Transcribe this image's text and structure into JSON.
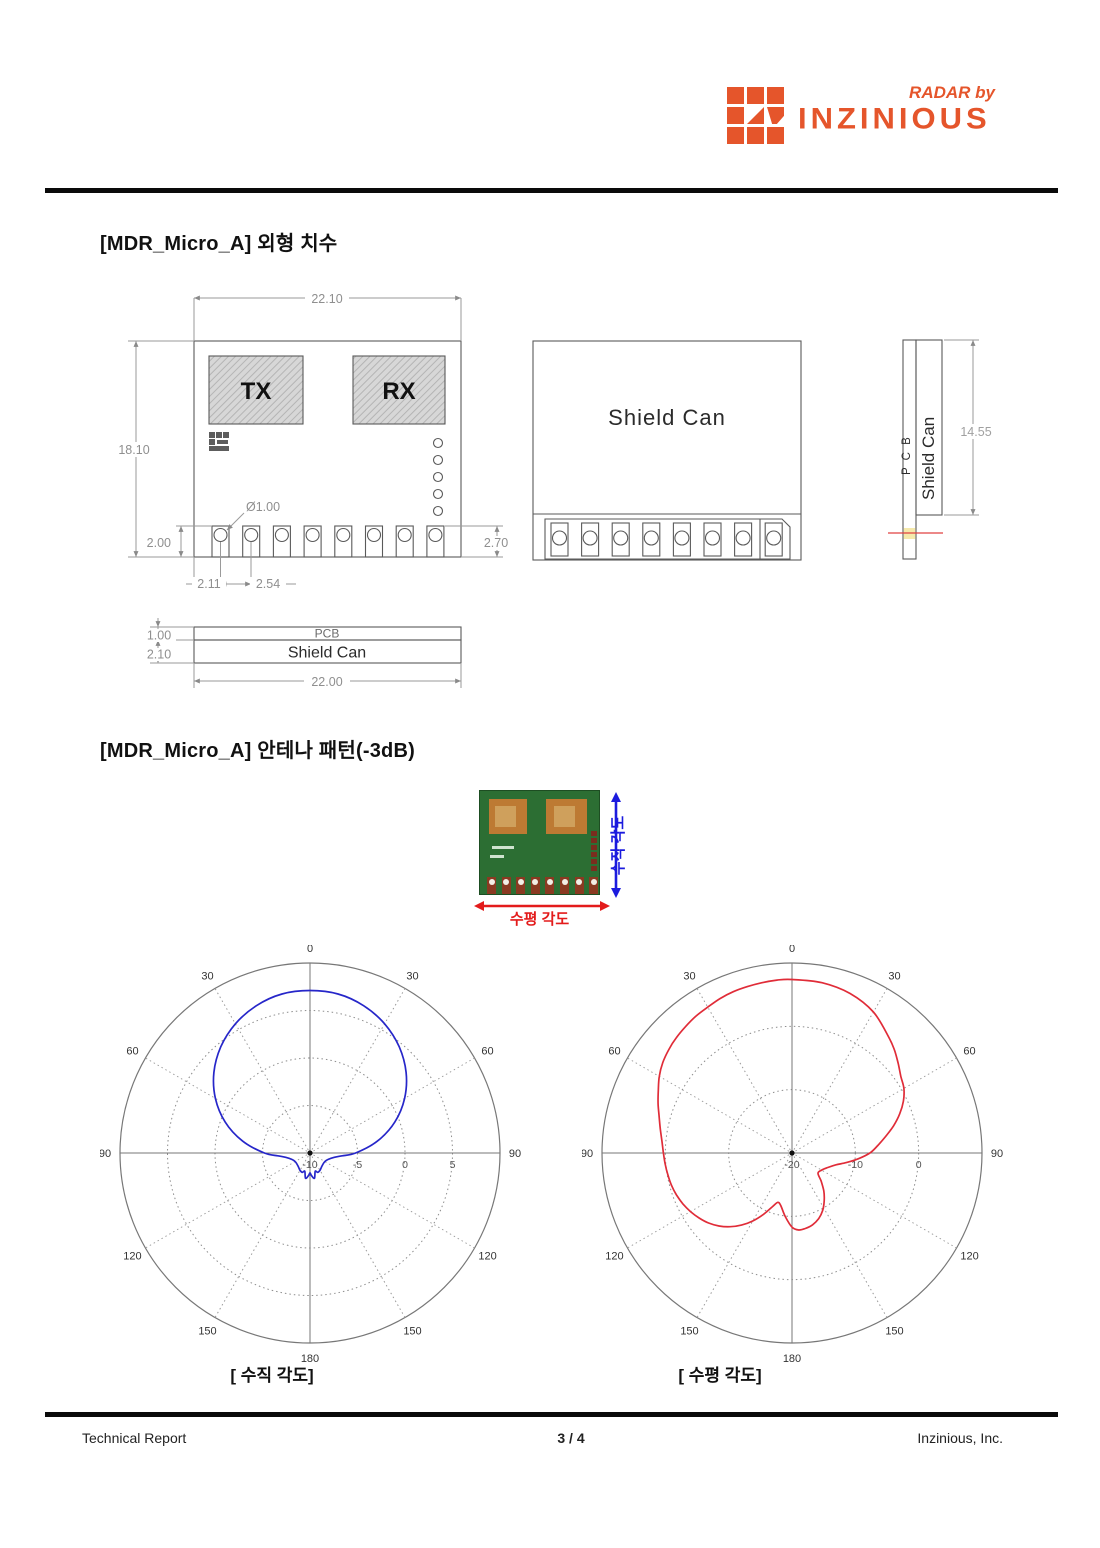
{
  "brand": {
    "tagline": "RADAR by",
    "name": "INZINIOUS",
    "color": "#e5552b"
  },
  "sections": {
    "dimensions_title": "[MDR_Micro_A] 외형 치수",
    "antenna_title": "[MDR_Micro_A] 안테나 패턴(-3dB)"
  },
  "drawing": {
    "front_view": {
      "tx_label": "TX",
      "rx_label": "RX",
      "width_dim": "22.10",
      "height_dim": "18.10",
      "pad_height_dim": "2.00",
      "hole_dim": "Ø1.00",
      "pitch_dim_1": "2.11",
      "pitch_dim_2": "2.54",
      "right_dim": "2.70"
    },
    "shield_view": {
      "label": "Shield Can"
    },
    "side_view": {
      "pcb_label": "P C B",
      "shield_label": "Shield Can",
      "height_dim": "14.55"
    },
    "stack_view": {
      "pcb_label": "PCB",
      "shield_label": "Shield Can",
      "pcb_dim": "1.00",
      "shield_dim": "2.10",
      "width_dim": "22.00"
    }
  },
  "photo": {
    "vertical_label": "수직 각도",
    "horizontal_label": "수평 각도",
    "vertical_color": "#1b1bde",
    "horizontal_color": "#e31b1b",
    "bottom_pad_count": 8,
    "side_pad_count": 6
  },
  "captions": {
    "left": "[ 수직 각도]",
    "right": "[ 수평 각도]"
  },
  "footer": {
    "left": "Technical Report",
    "page": "3 / 4",
    "right": "Inzinious, Inc."
  },
  "chart_data": [
    {
      "type": "line",
      "polar": true,
      "name": "vertical-angle-pattern",
      "title": "[ 수직 각도]",
      "color": "#2626c9",
      "grid": true,
      "angle_ticks": [
        {
          "a": 0,
          "t": "0"
        },
        {
          "a": 30,
          "t": "30"
        },
        {
          "a": -30,
          "t": "30"
        },
        {
          "a": 60,
          "t": "60"
        },
        {
          "a": -60,
          "t": "60"
        },
        {
          "a": 90,
          "t": "90"
        },
        {
          "a": -90,
          "t": "90"
        },
        {
          "a": 120,
          "t": "120"
        },
        {
          "a": -120,
          "t": "120"
        },
        {
          "a": 150,
          "t": "150"
        },
        {
          "a": -150,
          "t": "150"
        },
        {
          "a": 180,
          "t": "180"
        }
      ],
      "r_axis": {
        "min": -10,
        "max": 10,
        "ring_step": 5,
        "ticks": [
          {
            "v": -10,
            "t": "-10"
          },
          {
            "v": -5,
            "t": "-5"
          },
          {
            "v": 0,
            "t": "0"
          },
          {
            "v": 5,
            "t": "5"
          }
        ]
      },
      "points_deg_db": [
        [
          0,
          7.1
        ],
        [
          10,
          7.0
        ],
        [
          20,
          6.5
        ],
        [
          30,
          5.7
        ],
        [
          40,
          4.6
        ],
        [
          50,
          3.2
        ],
        [
          60,
          1.5
        ],
        [
          70,
          -0.5
        ],
        [
          80,
          -2.8
        ],
        [
          90,
          -5.2
        ],
        [
          95,
          -6.6
        ],
        [
          100,
          -7.4
        ],
        [
          110,
          -8.0
        ],
        [
          120,
          -8.2
        ],
        [
          130,
          -8.2
        ],
        [
          140,
          -8.1
        ],
        [
          150,
          -7.9
        ],
        [
          158,
          -7.8
        ],
        [
          164,
          -8.0
        ],
        [
          170,
          -7.3
        ],
        [
          176,
          -7.6
        ],
        [
          180,
          -7.9
        ],
        [
          184,
          -7.6
        ],
        [
          190,
          -7.3
        ],
        [
          196,
          -8.0
        ],
        [
          202,
          -7.8
        ],
        [
          210,
          -7.9
        ],
        [
          220,
          -8.1
        ],
        [
          230,
          -8.2
        ],
        [
          240,
          -8.2
        ],
        [
          250,
          -8.0
        ],
        [
          260,
          -7.4
        ],
        [
          265,
          -6.6
        ],
        [
          270,
          -5.2
        ],
        [
          280,
          -2.8
        ],
        [
          290,
          -0.5
        ],
        [
          300,
          1.5
        ],
        [
          310,
          3.2
        ],
        [
          320,
          4.6
        ],
        [
          330,
          5.7
        ],
        [
          340,
          6.5
        ],
        [
          350,
          7.0
        ]
      ]
    },
    {
      "type": "line",
      "polar": true,
      "name": "horizontal-angle-pattern",
      "title": "[ 수평 각도]",
      "color": "#e02c38",
      "grid": true,
      "angle_ticks": [
        {
          "a": 0,
          "t": "0"
        },
        {
          "a": 30,
          "t": "30"
        },
        {
          "a": -30,
          "t": "30"
        },
        {
          "a": 60,
          "t": "60"
        },
        {
          "a": -60,
          "t": "60"
        },
        {
          "a": 90,
          "t": "90"
        },
        {
          "a": -90,
          "t": "90"
        },
        {
          "a": 120,
          "t": "120"
        },
        {
          "a": -120,
          "t": "120"
        },
        {
          "a": 150,
          "t": "150"
        },
        {
          "a": -150,
          "t": "150"
        },
        {
          "a": 180,
          "t": "180"
        }
      ],
      "r_axis": {
        "min": -20,
        "max": 10,
        "ring_step": 10,
        "ticks": [
          {
            "v": -20,
            "t": "-20"
          },
          {
            "v": -10,
            "t": "-10"
          },
          {
            "v": 0,
            "t": "0"
          }
        ]
      },
      "points_deg_db": [
        [
          0,
          7.4
        ],
        [
          10,
          7.3
        ],
        [
          20,
          6.8
        ],
        [
          30,
          5.7
        ],
        [
          40,
          3.8
        ],
        [
          45,
          2.9
        ],
        [
          50,
          1.9
        ],
        [
          55,
          1.0
        ],
        [
          60,
          0.4
        ],
        [
          65,
          -0.6
        ],
        [
          70,
          -1.9
        ],
        [
          75,
          -3.4
        ],
        [
          80,
          -5.0
        ],
        [
          85,
          -6.4
        ],
        [
          90,
          -7.7
        ],
        [
          95,
          -9.5
        ],
        [
          100,
          -11.3
        ],
        [
          105,
          -12.8
        ],
        [
          112,
          -13.9
        ],
        [
          120,
          -14.6
        ],
        [
          128,
          -14.8
        ],
        [
          134,
          -13.6
        ],
        [
          140,
          -12.2
        ],
        [
          146,
          -10.9
        ],
        [
          152,
          -9.7
        ],
        [
          158,
          -8.8
        ],
        [
          164,
          -8.2
        ],
        [
          170,
          -7.9
        ],
        [
          175,
          -7.8
        ],
        [
          180,
          -8.3
        ],
        [
          186,
          -9.9
        ],
        [
          192,
          -11.5
        ],
        [
          196,
          -11.9
        ],
        [
          200,
          -11.0
        ],
        [
          205,
          -9.3
        ],
        [
          210,
          -7.6
        ],
        [
          215,
          -6.1
        ],
        [
          220,
          -4.8
        ],
        [
          225,
          -3.7
        ],
        [
          230,
          -2.8
        ],
        [
          235,
          -2.1
        ],
        [
          240,
          -1.5
        ],
        [
          245,
          -1.0
        ],
        [
          250,
          -0.6
        ],
        [
          255,
          -0.3
        ],
        [
          260,
          -0.1
        ],
        [
          265,
          0.1
        ],
        [
          270,
          0.3
        ],
        [
          275,
          0.6
        ],
        [
          280,
          1.1
        ],
        [
          285,
          1.7
        ],
        [
          290,
          2.5
        ],
        [
          295,
          3.3
        ],
        [
          300,
          4.2
        ],
        [
          305,
          4.9
        ],
        [
          310,
          5.4
        ],
        [
          315,
          5.8
        ],
        [
          320,
          6.1
        ],
        [
          325,
          6.4
        ],
        [
          330,
          6.6
        ],
        [
          335,
          6.9
        ],
        [
          340,
          7.1
        ],
        [
          345,
          7.2
        ],
        [
          350,
          7.3
        ],
        [
          355,
          7.4
        ]
      ]
    }
  ]
}
